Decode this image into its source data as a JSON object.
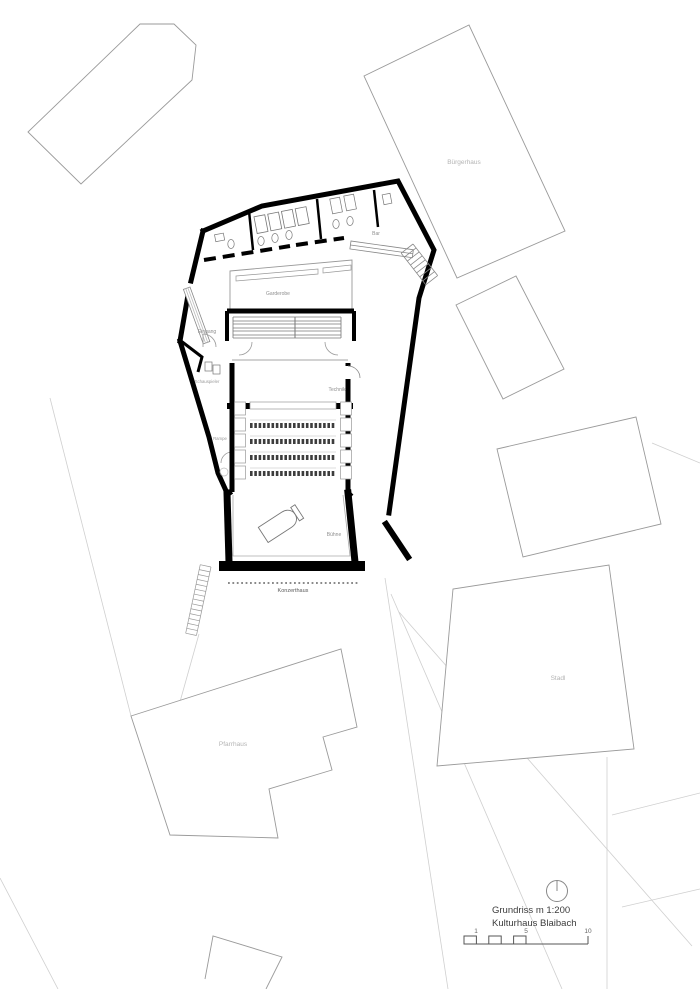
{
  "drawing": {
    "title_line1": "Grundriss m 1:200",
    "title_line2": "Kulturhaus Blaibach",
    "scale_ticks": {
      "one": "1",
      "five": "5",
      "ten": "10"
    },
    "room_labels": {
      "garderobe": "Garderobe",
      "eingang": "Eingang",
      "schauspieler": "Schauspieler",
      "technik": "Technik",
      "rampe": "Rampe",
      "buehne": "Bühne",
      "bar": "Bar",
      "konzerthaus": "Konzerthaus"
    },
    "context_labels": {
      "buergerhaus": "Bürgerhaus",
      "stadl": "Stadl",
      "pfarrhaus": "Pfarrhaus"
    },
    "icons": {
      "north_arrow": "north-arrow-icon",
      "piano": "grand-piano-icon",
      "scale_bar": "scale-bar"
    },
    "colors": {
      "wall": "#000000",
      "building_outline": "#9a9a9a",
      "site_line": "#cfcfcf",
      "room_label": "#8f8f8f",
      "context_label": "#b4b4b4",
      "title_text": "#3c3c3c"
    }
  }
}
